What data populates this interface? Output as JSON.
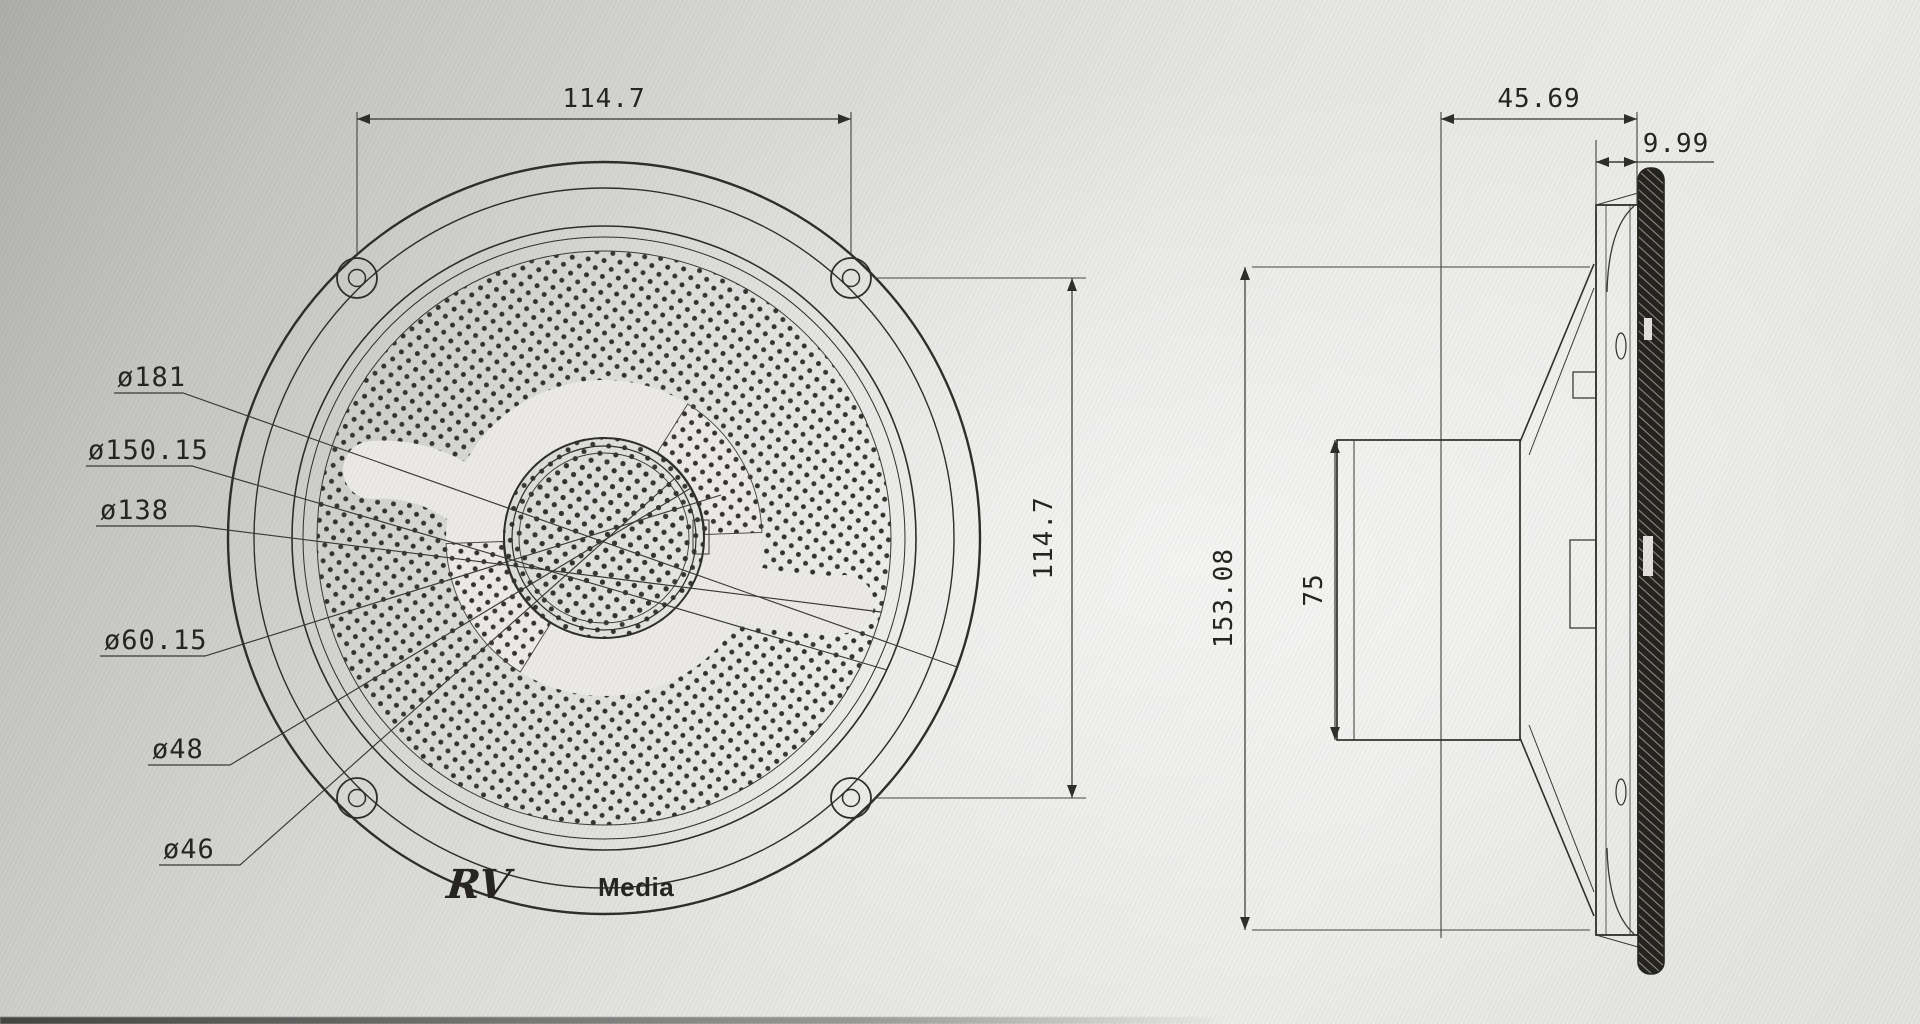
{
  "drawing": {
    "type": "speaker-engineering-drawing",
    "ink_color": "#2f2e2b",
    "paper_color": "#e7e7e5"
  },
  "front_view": {
    "dim_top": "114.7",
    "dim_right": "114.7",
    "diameter_labels": {
      "d_outer": "ø181",
      "d_grille": "ø150.15",
      "d_perforation": "ø138",
      "d_swirl": "ø60.15",
      "d_ring_outer": "ø48",
      "d_ring_inner": "ø46"
    },
    "logo": {
      "rv": "RV",
      "media": "Media"
    }
  },
  "side_view": {
    "dim_depth": "45.69",
    "dim_flange_thickness": "9.99",
    "dim_overall_height": "153.08",
    "dim_magnet_height": "75"
  }
}
